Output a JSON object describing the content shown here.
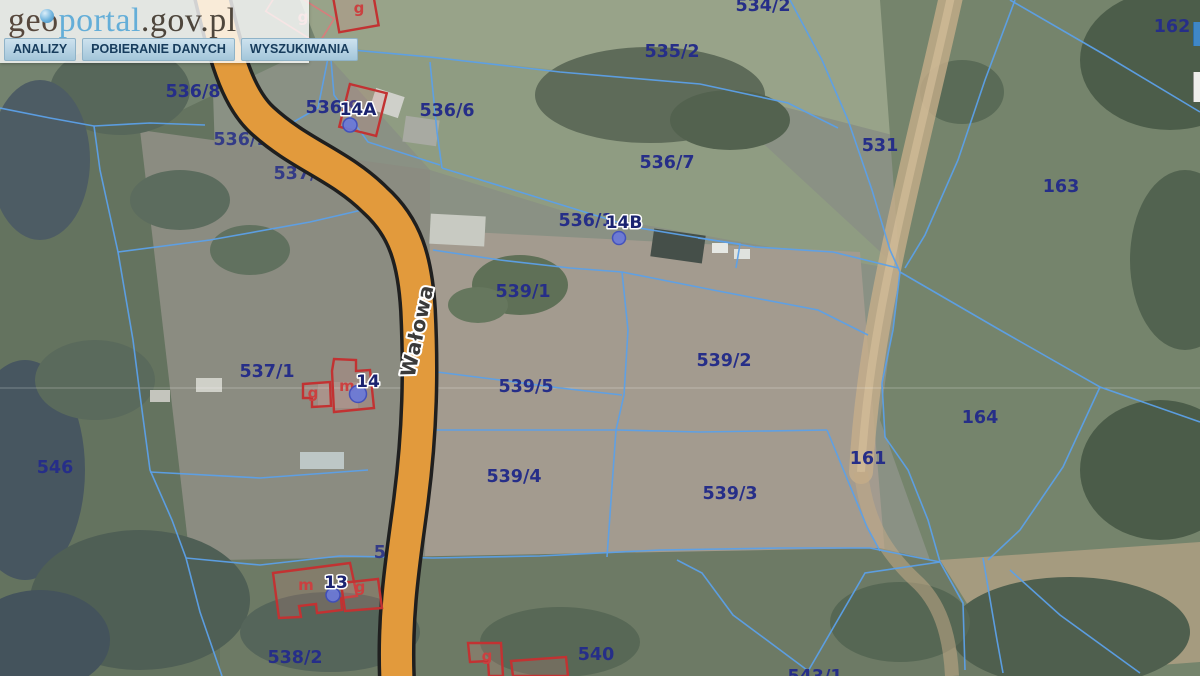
{
  "header": {
    "logo": {
      "geo": "geo",
      "portal": "portal",
      "suffix": ".gov.pl"
    },
    "menu": [
      {
        "label": "ANALIZY"
      },
      {
        "label": "POBIERANIE DANYCH"
      },
      {
        "label": "WYSZUKIWANIA"
      }
    ]
  },
  "map": {
    "street": {
      "name": "Wałowa"
    },
    "parcels": [
      {
        "id": "534/2"
      },
      {
        "id": "535/2"
      },
      {
        "id": "162"
      },
      {
        "id": "536/8"
      },
      {
        "id": "536/9"
      },
      {
        "id": "536/6"
      },
      {
        "id": "536/7"
      },
      {
        "id": "531"
      },
      {
        "id": "163"
      },
      {
        "id": "536/10"
      },
      {
        "id": "537/2"
      },
      {
        "id": "536/1"
      },
      {
        "id": "539/1"
      },
      {
        "id": "539/2"
      },
      {
        "id": "539/5"
      },
      {
        "id": "537/1"
      },
      {
        "id": "546"
      },
      {
        "id": "539/4"
      },
      {
        "id": "539/3"
      },
      {
        "id": "164"
      },
      {
        "id": "161"
      },
      {
        "id": "542"
      },
      {
        "id": "538/2"
      },
      {
        "id": "540"
      },
      {
        "id": "543/1"
      }
    ],
    "addresses": [
      {
        "number": "14A"
      },
      {
        "number": "14B"
      },
      {
        "number": "14"
      },
      {
        "number": "13"
      }
    ],
    "building_marks": [
      {
        "t": "g"
      },
      {
        "t": "g"
      },
      {
        "t": "g"
      },
      {
        "t": "m"
      },
      {
        "t": "m"
      },
      {
        "t": "g"
      },
      {
        "t": "g"
      }
    ],
    "colors": {
      "parcel_line": "#5ca0e8",
      "parcel_label": "#262e88",
      "road_fill": "#e29a3c",
      "road_casing": "#1f1f1f",
      "building_outline": "#c23232",
      "address_label": "#1b2370",
      "address_point": "#6b7ad9"
    }
  }
}
